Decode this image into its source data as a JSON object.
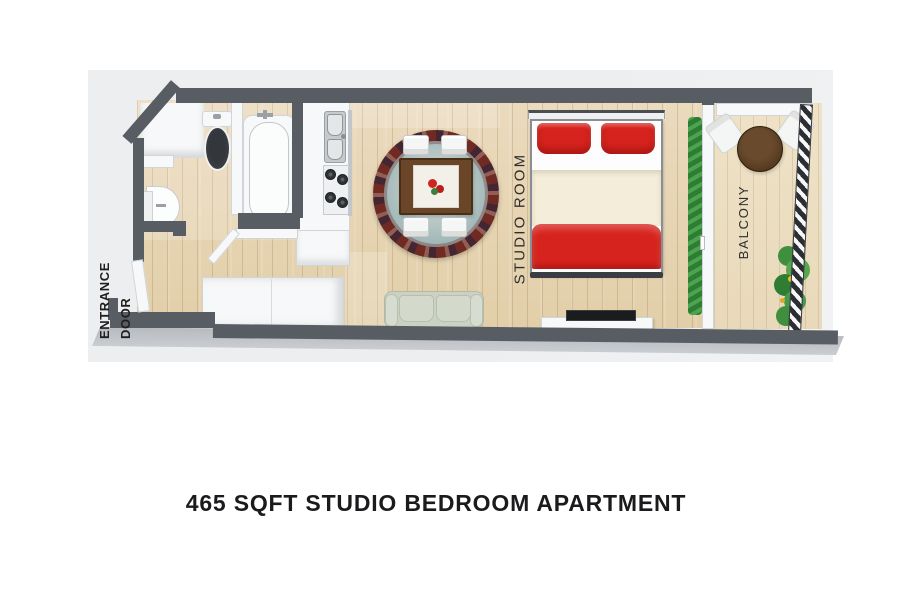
{
  "caption": "465 SQFT STUDIO BEDROOM APARTMENT",
  "labels": {
    "entrance_door": "ENTRANCE DOOR",
    "studio_room": "STUDIO ROOM",
    "balcony": "BALCONY"
  },
  "colors": {
    "wall": "#585d64",
    "wall_side": "#b7babe",
    "backdrop": "#eceef0",
    "floor_wood": "#e7d5b5",
    "balcony_floor": "#eee1c6",
    "accent_red": "#d7231d",
    "blanket_cream": "#f3edda",
    "sofa_sage": "#cbd2c3",
    "rug_border_maroon": "#6e2a23",
    "rug_field_teal": "#a9bfc0",
    "dining_table_brown": "#6b4527",
    "balcony_table_brown": "#53381f",
    "plant_green": "#3f9442",
    "railing_stripe": "#2b2e33"
  },
  "furniture": [
    "toilet",
    "bathtub",
    "pedestal-sink",
    "kitchen-counter",
    "kitchen-sink",
    "stove",
    "wardrobe",
    "dining-table",
    "dining-chair",
    "area-rug",
    "double-bed",
    "pillow",
    "sofa",
    "tv",
    "tv-stand",
    "window-planter",
    "sliding-door",
    "balcony-table",
    "balcony-chair",
    "potted-plant",
    "balcony-railing",
    "entrance-door",
    "bathroom-door"
  ]
}
